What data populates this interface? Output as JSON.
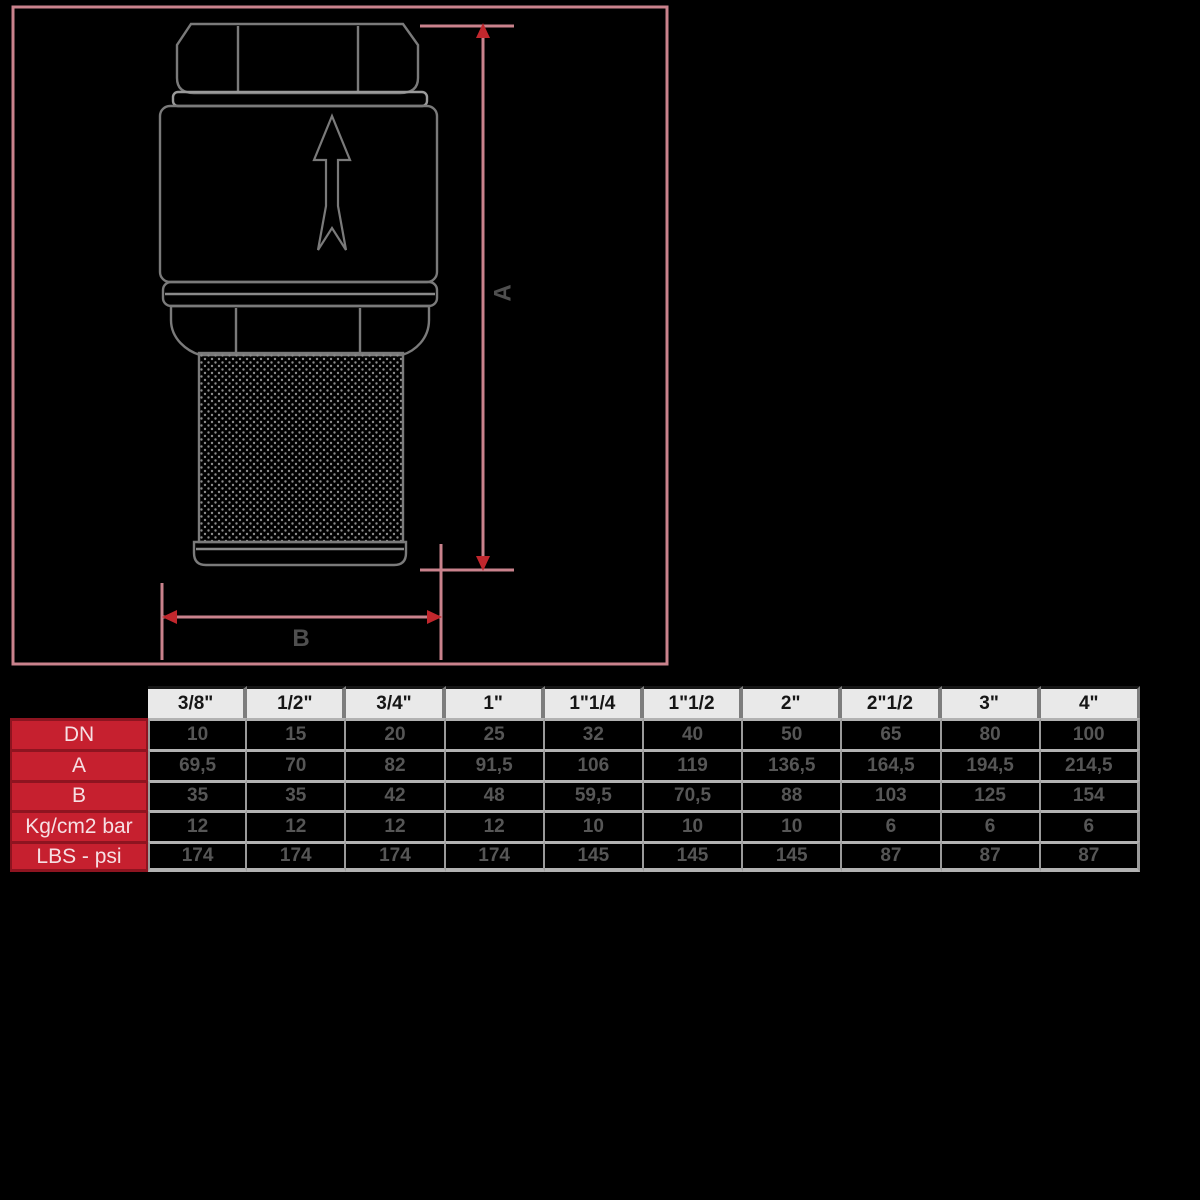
{
  "drawing": {
    "dim_a_label": "A",
    "dim_b_label": "B",
    "flow_arrow": "up-arrow-icon",
    "colors": {
      "dimension_pink": "#c9828c",
      "arrowhead_red": "#c1272d",
      "valve_line_gray": "#7a7a7a",
      "label_gray": "#4f4f4f"
    }
  },
  "table": {
    "colors": {
      "header_bg": "#e9e9e9",
      "label_bg": "#c6202f",
      "label_text": "#f6dfe3",
      "value_text": "#565656",
      "grid_gray": "#b2b2b2"
    },
    "sizes": [
      "3/8\"",
      "1/2\"",
      "3/4\"",
      "1\"",
      "1\"1/4",
      "1\"1/2",
      "2\"",
      "2\"1/2",
      "3\"",
      "4\""
    ],
    "rows": [
      {
        "label": "DN",
        "values": [
          "10",
          "15",
          "20",
          "25",
          "32",
          "40",
          "50",
          "65",
          "80",
          "100"
        ]
      },
      {
        "label": "A",
        "values": [
          "69,5",
          "70",
          "82",
          "91,5",
          "106",
          "119",
          "136,5",
          "164,5",
          "194,5",
          "214,5"
        ]
      },
      {
        "label": "B",
        "values": [
          "35",
          "35",
          "42",
          "48",
          "59,5",
          "70,5",
          "88",
          "103",
          "125",
          "154"
        ]
      },
      {
        "label": "Kg/cm2 bar",
        "values": [
          "12",
          "12",
          "12",
          "12",
          "10",
          "10",
          "10",
          "6",
          "6",
          "6"
        ]
      },
      {
        "label": "LBS - psi",
        "values": [
          "174",
          "174",
          "174",
          "174",
          "145",
          "145",
          "145",
          "87",
          "87",
          "87"
        ]
      }
    ]
  }
}
